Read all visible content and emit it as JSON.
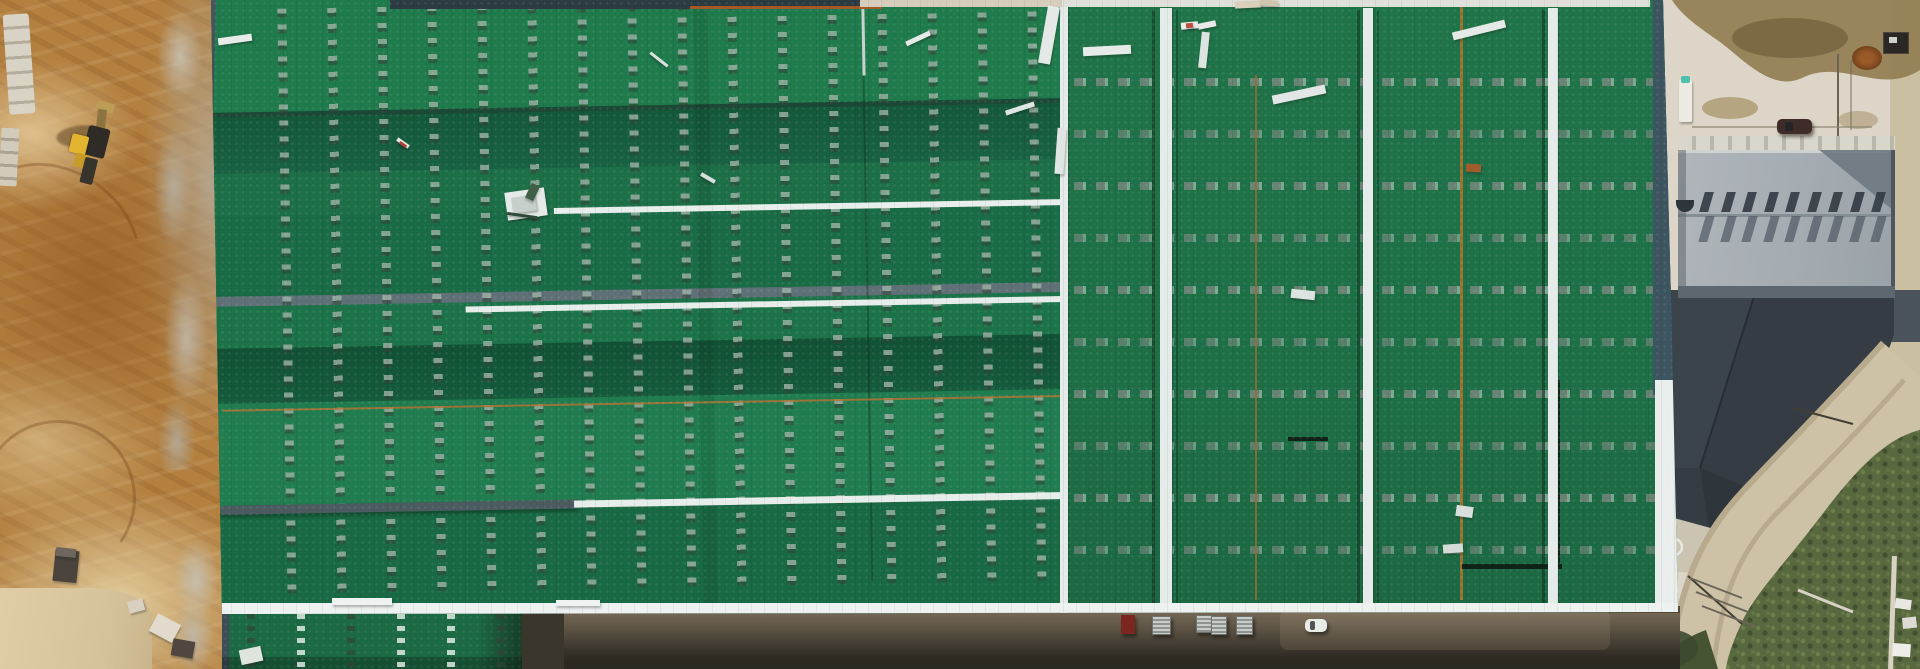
{
  "meta": {
    "title": "Aerial drone photograph of an industrial warehouse complex under construction",
    "width": 1920,
    "height": 669,
    "visible_text": "none"
  },
  "palette": {
    "roof_green_light": "#27814f",
    "roof_green_mid": "#1e7048",
    "roof_green_dark": "#135436",
    "walkway_white": "#e9efed",
    "ridge_gray": "#5f7076",
    "fascia_slate": "#3c5560",
    "dirt_brown": "#b3803f",
    "dirt_light_sand": "#dcc391",
    "rubble_gray": "#b7b1a3",
    "concrete_beige": "#ddd6c8",
    "stain_tan": "#917c50",
    "aux_roof_gray": "#a6adb2",
    "vent_shadow_gray": "#49525a",
    "dark_roof_charcoal": "#353c43",
    "road_tan": "#cdc1a6",
    "vegetation_green": "#59693f",
    "service_road_shadow": "#3a352c",
    "excavator_yellow": "#e2b42f",
    "truck_red": "#7c2620",
    "car_white": "#eaece8"
  },
  "scene": {
    "areas": [
      {
        "name": "construction-dirt-area",
        "position": "left edge",
        "description": "graded brown earth with machine tracks, stone block stacks, gray rubble and a yellow excavator"
      },
      {
        "name": "main-warehouse-roof",
        "position": "center",
        "description": "very large green metal roof; left half has horizontal ridge bands with vertical dashed skylight strips, right half has vertical planes with horizontal dashed strips, white walkways and white ridge caps, scattered white boards"
      },
      {
        "name": "lower-roof-wing",
        "position": "bottom left",
        "description": "green roof continues below a gray catwalk to the image edge"
      },
      {
        "name": "auxiliary-building",
        "position": "upper right",
        "description": "gray flat-roofed building with two rows of sawtooth vent shadows"
      },
      {
        "name": "dark-annex-roof",
        "position": "right",
        "description": "charcoal faceted roof with curved outer edge"
      },
      {
        "name": "perimeter-road",
        "position": "right",
        "description": "tan road curving around the dark roof toward the bottom edge"
      },
      {
        "name": "vegetation",
        "position": "bottom right corner",
        "description": "shrubs and weeds outside the road"
      },
      {
        "name": "service-road",
        "position": "bottom center",
        "description": "shadowed road along the building with parked trucks and a white car"
      }
    ],
    "objects": {
      "excavator": {
        "color": "yellow",
        "location": "upper left dirt area"
      },
      "parked_vehicle_count": 7,
      "debris_piece_count": 34,
      "roof_skylight_columns": 16,
      "roof_skylight_rows": 10,
      "sawtooth_vent_count": 9
    }
  },
  "generate": {
    "dash_columns": {
      "xs": [
        72,
        122,
        172,
        222,
        272,
        322,
        372,
        422,
        472,
        522,
        572,
        622,
        672,
        722,
        772,
        822
      ],
      "top": 18,
      "height": 590,
      "width": 9
    },
    "wing_columns": {
      "xs": [
        25,
        75,
        125,
        175,
        225,
        275
      ],
      "styles": [
        "dark",
        "light",
        "dark",
        "light",
        "light",
        "dark"
      ],
      "width": 8
    },
    "dash_rows": {
      "ys": [
        78,
        130,
        182,
        234,
        286,
        338,
        390,
        442,
        494,
        546
      ],
      "left": 14,
      "width": 592,
      "height": 8
    },
    "teeth": {
      "x0": 24,
      "step": 21.5,
      "count": 9,
      "width": 9,
      "skew": -16,
      "rows": [
        {
          "y": 42,
          "h": 20,
          "c": "rgba(50,58,66,0.9)"
        },
        {
          "y": 66,
          "h": 26,
          "c": "rgba(72,82,92,0.65)"
        }
      ]
    },
    "vehicles": [
      {
        "type": "flatbed-truck-red",
        "x": 1121,
        "y": 615,
        "w": 14,
        "h": 19,
        "c": "#7c2620"
      },
      {
        "type": "box-truck",
        "x": 1152,
        "y": 616,
        "w": 17,
        "h": 17
      },
      {
        "type": "box-truck",
        "x": 1196,
        "y": 615,
        "w": 14,
        "h": 16
      },
      {
        "type": "box-truck",
        "x": 1211,
        "y": 616,
        "w": 14,
        "h": 17
      },
      {
        "type": "box-truck",
        "x": 1236,
        "y": 616,
        "w": 15,
        "h": 17
      },
      {
        "type": "car-white",
        "x": 1305,
        "y": 619,
        "w": 22,
        "h": 13,
        "c": "#eaece8"
      },
      {
        "type": "car-dark-parked",
        "x": 1777,
        "y": 119,
        "w": 35,
        "h": 15,
        "c": "#3f2b28"
      }
    ],
    "debris": [
      {
        "x": 218,
        "y": 36,
        "w": 34,
        "h": 7,
        "r": -8,
        "c": "#e8ece9"
      },
      {
        "x": 396,
        "y": 141,
        "w": 14,
        "h": 4,
        "r": 35,
        "c": "#e6e6e2"
      },
      {
        "x": 399,
        "y": 143,
        "w": 8,
        "h": 3,
        "r": 35,
        "c": "#ad4238"
      },
      {
        "x": 506,
        "y": 190,
        "w": 40,
        "h": 28,
        "r": -8,
        "c": "#e4eae7"
      },
      {
        "x": 512,
        "y": 196,
        "w": 24,
        "h": 16,
        "r": -8,
        "c": "#c6cfca"
      },
      {
        "x": 528,
        "y": 184,
        "w": 9,
        "h": 16,
        "r": 25,
        "c": "#3f6046"
      },
      {
        "x": 507,
        "y": 214,
        "w": 30,
        "h": 3,
        "r": 8,
        "c": "#2e4a38"
      },
      {
        "x": 648,
        "y": 58,
        "w": 22,
        "h": 3,
        "r": 38,
        "c": "#dce2df"
      },
      {
        "x": 700,
        "y": 176,
        "w": 16,
        "h": 4,
        "r": 30,
        "c": "#d8dedc"
      },
      {
        "x": 905,
        "y": 36,
        "w": 26,
        "h": 5,
        "r": -25,
        "c": "#e6eae8"
      },
      {
        "x": 1005,
        "y": 106,
        "w": 30,
        "h": 5,
        "r": -18,
        "c": "#dfe5e2"
      },
      {
        "x": 1043,
        "y": 6,
        "w": 12,
        "h": 58,
        "r": 10,
        "c": "#e4e9e7"
      },
      {
        "x": 1056,
        "y": 128,
        "w": 9,
        "h": 46,
        "r": 4,
        "c": "#dfe5e2"
      },
      {
        "x": 1083,
        "y": 46,
        "w": 48,
        "h": 9,
        "r": -3,
        "c": "#e6ebe9"
      },
      {
        "x": 1181,
        "y": 22,
        "w": 17,
        "h": 7,
        "r": -5,
        "c": "#eceeec"
      },
      {
        "x": 1186,
        "y": 23,
        "w": 7,
        "h": 5,
        "r": -5,
        "c": "#bf4e42"
      },
      {
        "x": 1198,
        "y": 22,
        "w": 18,
        "h": 6,
        "r": -12,
        "c": "#e8ebe9"
      },
      {
        "x": 1200,
        "y": 32,
        "w": 8,
        "h": 36,
        "r": 6,
        "c": "#dde3e0"
      },
      {
        "x": 1272,
        "y": 90,
        "w": 54,
        "h": 9,
        "r": -12,
        "c": "#e2e7e5"
      },
      {
        "x": 1291,
        "y": 290,
        "w": 24,
        "h": 9,
        "r": 6,
        "c": "#dde3e0"
      },
      {
        "x": 1452,
        "y": 26,
        "w": 54,
        "h": 8,
        "r": -14,
        "c": "#e5eae8"
      },
      {
        "x": 1466,
        "y": 164,
        "w": 15,
        "h": 8,
        "r": 3,
        "c": "#a05c2c"
      },
      {
        "x": 1456,
        "y": 506,
        "w": 17,
        "h": 11,
        "r": 8,
        "c": "#d8dedb"
      },
      {
        "x": 1443,
        "y": 544,
        "w": 20,
        "h": 9,
        "r": -4,
        "c": "#d4dad7"
      },
      {
        "x": 240,
        "y": 648,
        "w": 22,
        "h": 15,
        "r": -12,
        "c": "#dfe4df"
      },
      {
        "x": 152,
        "y": 618,
        "w": 26,
        "h": 20,
        "r": 28,
        "c": "#e2dbcd"
      },
      {
        "x": 172,
        "y": 640,
        "w": 22,
        "h": 17,
        "r": 10,
        "c": "#50483e"
      },
      {
        "x": 128,
        "y": 600,
        "w": 16,
        "h": 12,
        "r": -15,
        "c": "#d8d0c0"
      },
      {
        "x": 54,
        "y": 550,
        "w": 24,
        "h": 32,
        "r": 6,
        "c": "#4a443c"
      },
      {
        "x": 56,
        "y": 548,
        "w": 20,
        "h": 9,
        "r": 6,
        "c": "#6e665c"
      },
      {
        "x": 1235,
        "y": 1,
        "w": 26,
        "h": 7,
        "r": -3,
        "c": "#d9cfbd"
      },
      {
        "x": 1260,
        "y": 0,
        "w": 18,
        "h": 6,
        "r": 5,
        "c": "#cfc4ae"
      },
      {
        "x": 332,
        "y": 598,
        "w": 60,
        "h": 7,
        "r": 0,
        "c": "#eef2f0"
      },
      {
        "x": 556,
        "y": 600,
        "w": 44,
        "h": 6,
        "r": 0,
        "c": "#eef2f0"
      }
    ]
  }
}
